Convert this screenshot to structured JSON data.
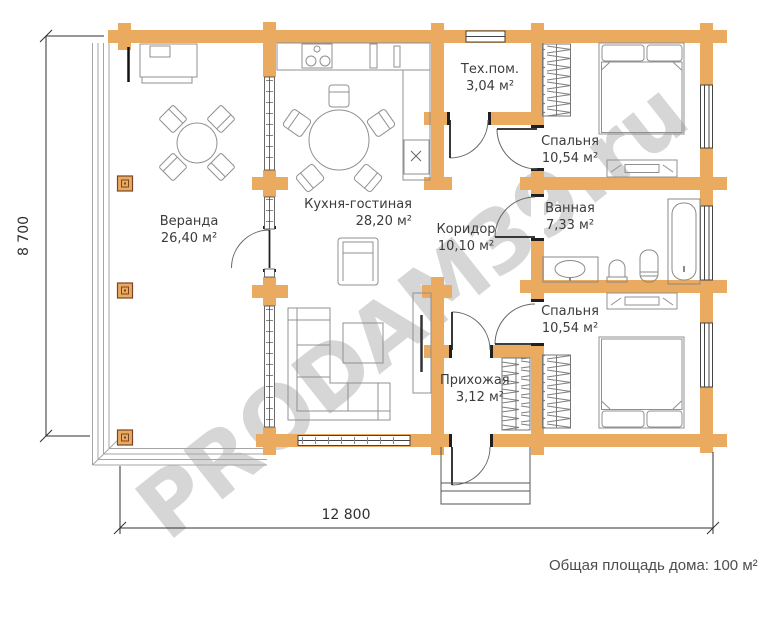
{
  "watermark_text": "PRODAM39.ru",
  "summary_text": "Общая площадь дома: 100 м²",
  "dimensions": {
    "height": "8 700",
    "width": "12 800"
  },
  "rooms": [
    {
      "id": "veranda",
      "name": "Веранда",
      "area": "26,40 м²"
    },
    {
      "id": "kitchen-living",
      "name": "Кухня-гостиная",
      "area": "28,20 м²"
    },
    {
      "id": "tech-room",
      "name": "Тех.пом.",
      "area": "3,04 м²"
    },
    {
      "id": "bedroom-1",
      "name": "Спальня",
      "area": "10,54 м²"
    },
    {
      "id": "bathroom",
      "name": "Ванная",
      "area": "7,33 м²"
    },
    {
      "id": "corridor",
      "name": "Коридор",
      "area": "10,10 м²"
    },
    {
      "id": "bedroom-2",
      "name": "Спальня",
      "area": "10,54 м²"
    },
    {
      "id": "hallway",
      "name": "Прихожая",
      "area": "3,12 м²"
    }
  ],
  "colors": {
    "wall": "#EAAA60",
    "watermark": "#D6D6D6",
    "furniture_line": "#909090",
    "dimension_line": "#2F2F2F"
  }
}
